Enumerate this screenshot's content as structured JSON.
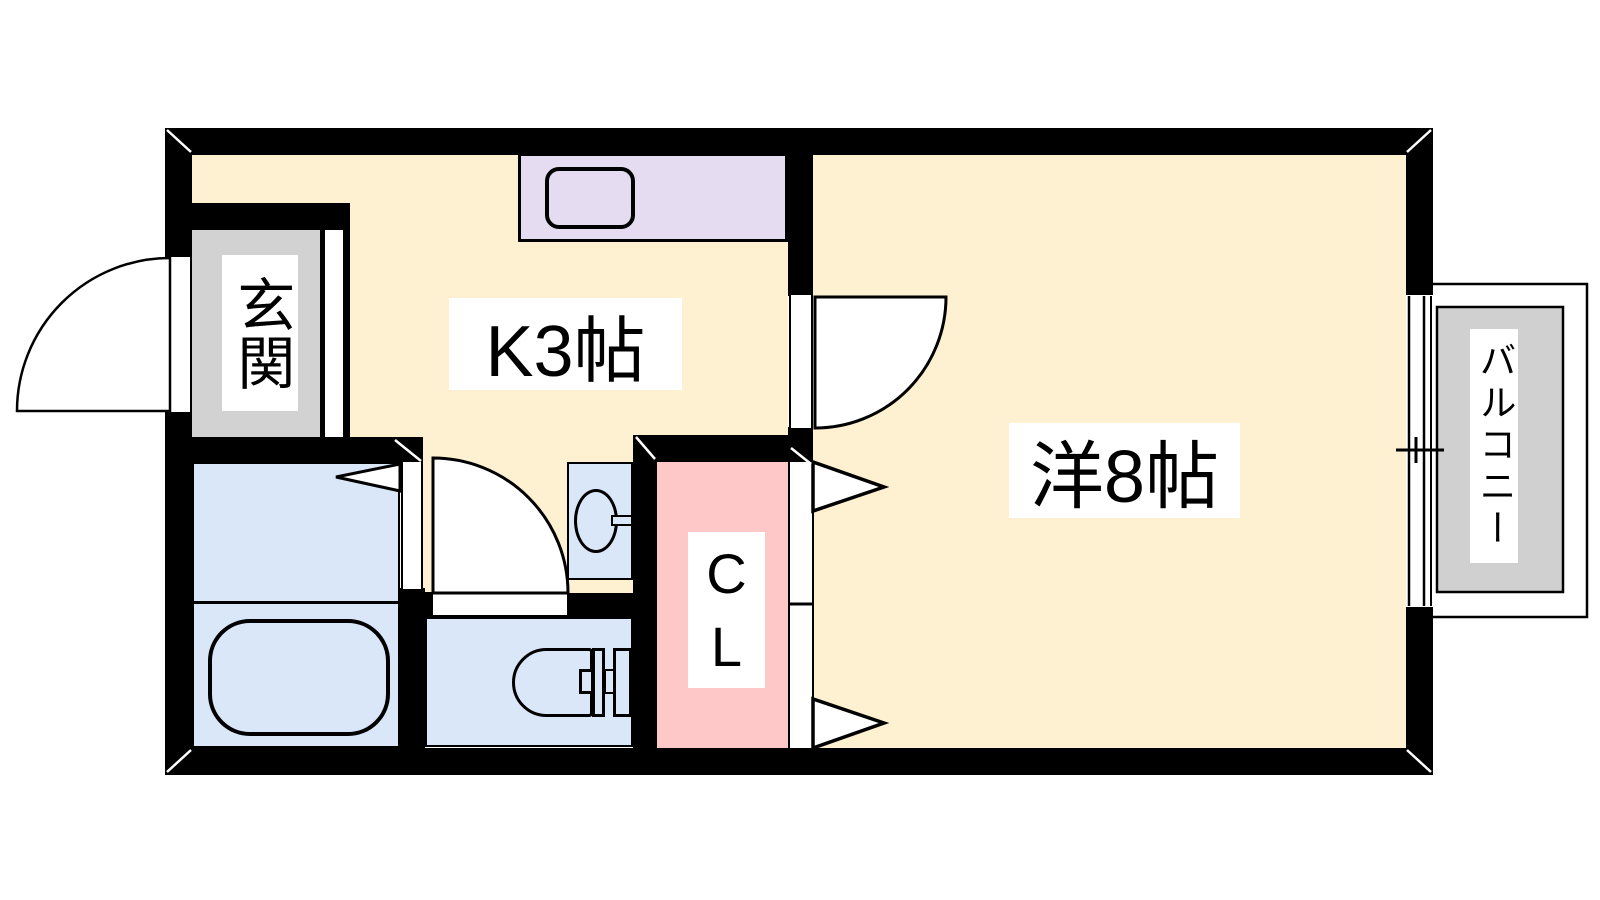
{
  "plan": {
    "type": "apartment-floorplan-1K",
    "labels": {
      "entrance": "玄関",
      "kitchen": "K3帖",
      "main_room": "洋8帖",
      "closet": "C\nL",
      "balcony": "バルコニー"
    },
    "colors": {
      "wall": "#000000",
      "line": "#000000",
      "floor": "#FDF1D2",
      "wet": "#D9E7F9",
      "closet": "#FFC8C8",
      "counter": "#E5DCF2",
      "entrance": "#D2D2D2",
      "balcony": "#D0D0D0",
      "label_bg": "#FFFFFF"
    }
  }
}
